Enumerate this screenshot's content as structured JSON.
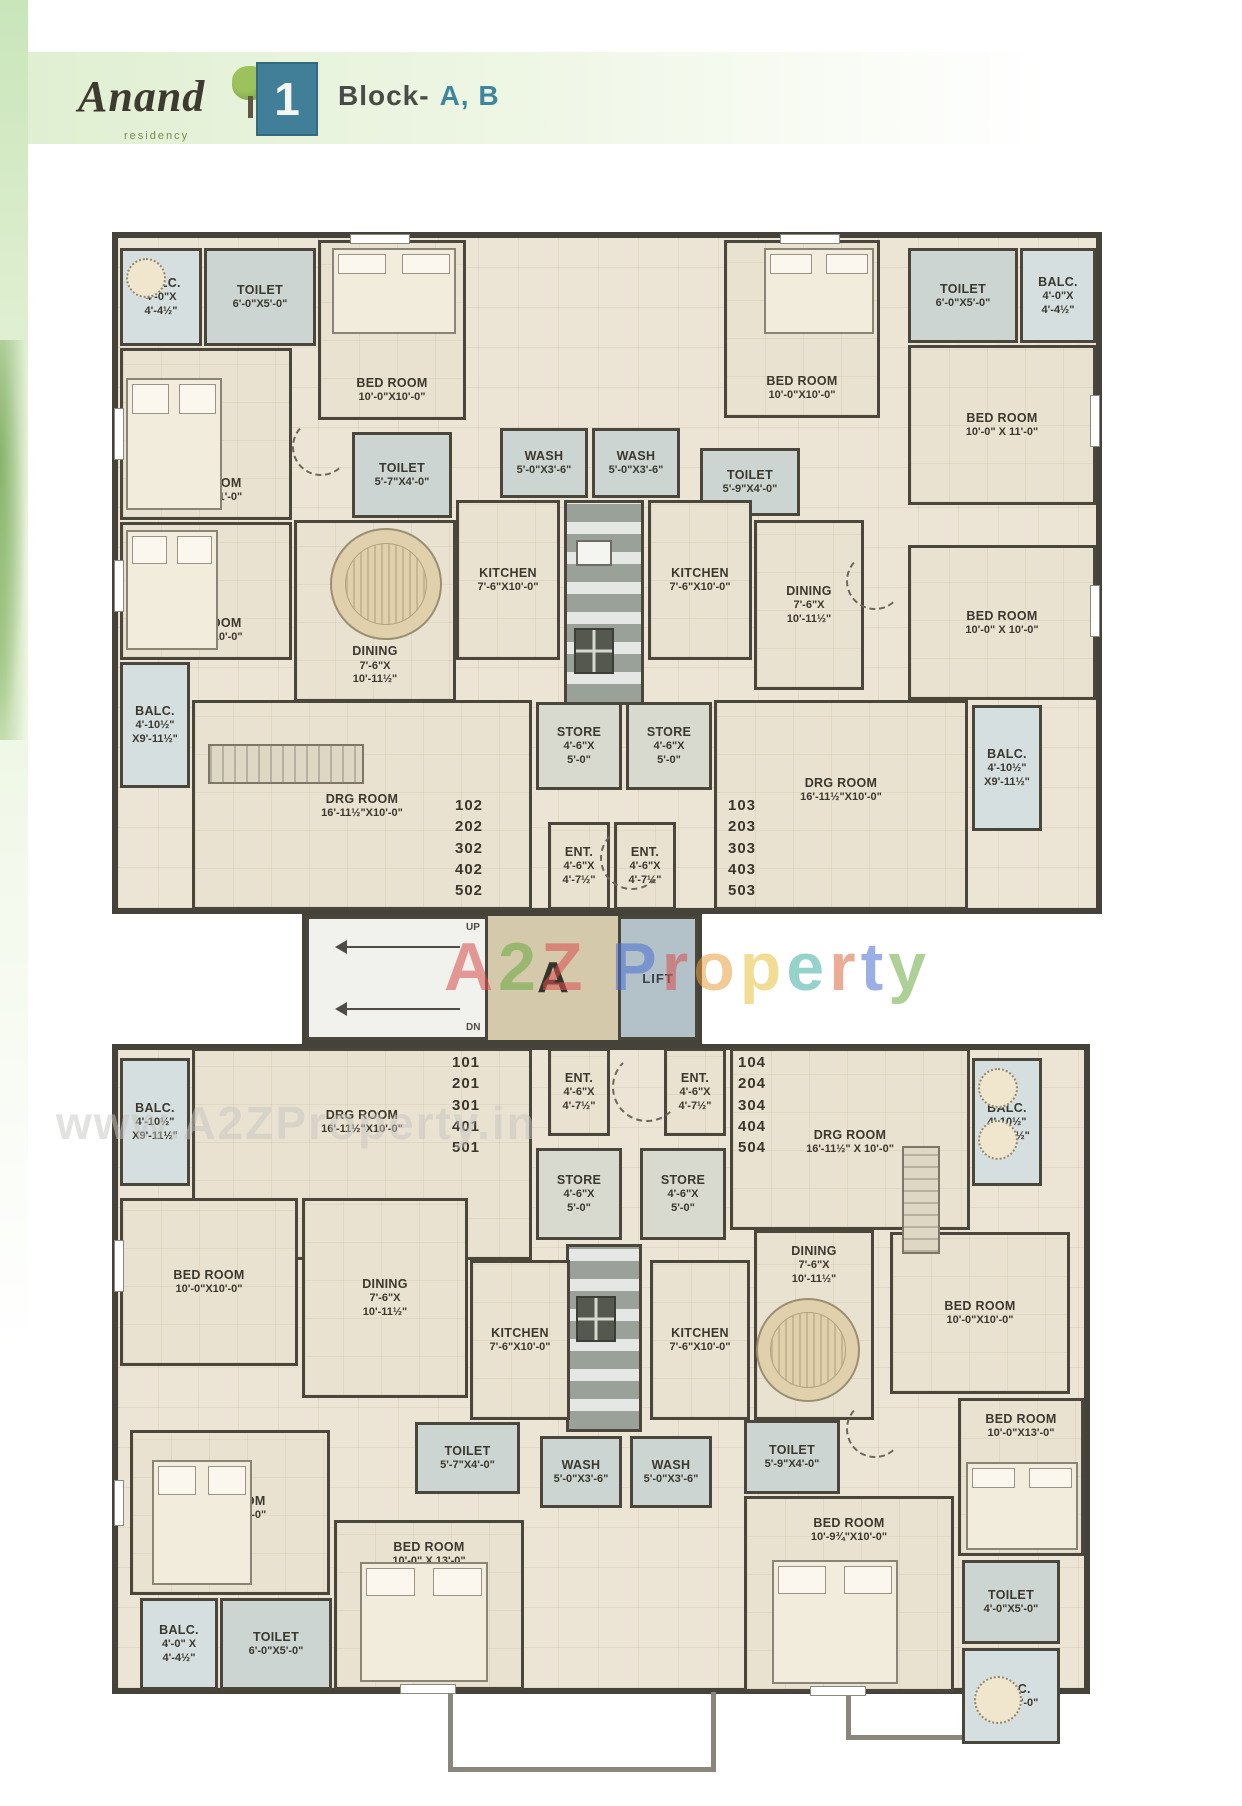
{
  "header": {
    "logo_title": "Anand",
    "logo_subtitle": "residency",
    "sheet_number": "1",
    "block_prefix": "Block-",
    "block_names": "A, B",
    "accent_color": "#3e86a0"
  },
  "core": {
    "lobby_letter": "A",
    "lift_label": "LIFT",
    "up_label": "UP",
    "dn_label": "DN"
  },
  "watermarks": {
    "center_letters": [
      {
        "ch": "A",
        "color": "#d94f4f"
      },
      {
        "ch": "2",
        "color": "#6aaa3f"
      },
      {
        "ch": "Z",
        "color": "#d94f4f"
      },
      {
        "ch": " ",
        "color": "#000000"
      },
      {
        "ch": "P",
        "color": "#4a6fd0"
      },
      {
        "ch": "r",
        "color": "#d94f4f"
      },
      {
        "ch": "o",
        "color": "#e8a03f"
      },
      {
        "ch": "p",
        "color": "#e8c23f"
      },
      {
        "ch": "e",
        "color": "#3fae9f"
      },
      {
        "ch": "r",
        "color": "#d96a3f"
      },
      {
        "ch": "t",
        "color": "#4a6fd0"
      },
      {
        "ch": "y",
        "color": "#6aaa3f"
      }
    ],
    "bottom_text": "www.A2ZProperty.in"
  },
  "plan": {
    "wall_color": "#4a463c",
    "rooms": [
      {
        "name": "balc-top-left",
        "lines": [
          "BALC.",
          "4'-0\"X",
          "4'-4½\""
        ],
        "x": 120,
        "y": 248,
        "w": 82,
        "h": 98,
        "kind": "balc"
      },
      {
        "name": "toilet-top-left",
        "lines": [
          "TOILET",
          "6'-0\"X5'-0\""
        ],
        "x": 204,
        "y": 248,
        "w": 112,
        "h": 98,
        "kind": "wet"
      },
      {
        "name": "bedroom-top-center-left",
        "lines": [
          "BED ROOM",
          "10'-0\"X10'-0\""
        ],
        "x": 318,
        "y": 240,
        "w": 148,
        "h": 180,
        "kind": "room",
        "pos": "bottom"
      },
      {
        "name": "bedroom-left-1",
        "lines": [
          "BED ROOM",
          "10'-0\" X 11'-0\""
        ],
        "x": 120,
        "y": 348,
        "w": 172,
        "h": 172,
        "kind": "room",
        "pos": "bottom"
      },
      {
        "name": "bedroom-left-2",
        "lines": [
          "BED ROOM",
          "10'-0\" X 10'-0\""
        ],
        "x": 120,
        "y": 522,
        "w": 172,
        "h": 138,
        "kind": "room",
        "pos": "bottom"
      },
      {
        "name": "toilet-inner-left",
        "lines": [
          "TOILET",
          "5'-7\"X4'-0\""
        ],
        "x": 352,
        "y": 432,
        "w": 100,
        "h": 86,
        "kind": "wet"
      },
      {
        "name": "wash-left",
        "lines": [
          "WASH",
          "5'-0\"X3'-6\""
        ],
        "x": 500,
        "y": 428,
        "w": 88,
        "h": 70,
        "kind": "wet"
      },
      {
        "name": "wash-right",
        "lines": [
          "WASH",
          "5'-0\"X3'-6\""
        ],
        "x": 592,
        "y": 428,
        "w": 88,
        "h": 70,
        "kind": "wet"
      },
      {
        "name": "toilet-inner-right",
        "lines": [
          "TOILET",
          "5'-9\"X4'-0\""
        ],
        "x": 700,
        "y": 448,
        "w": 100,
        "h": 68,
        "kind": "wet"
      },
      {
        "name": "dining-left",
        "lines": [
          "DINING",
          "7'-6\"X",
          "10'-11½\""
        ],
        "x": 294,
        "y": 520,
        "w": 162,
        "h": 182,
        "kind": "room",
        "pos": "bottom"
      },
      {
        "name": "kitchen-left",
        "lines": [
          "KITCHEN",
          "7'-6\"X10'-0\""
        ],
        "x": 456,
        "y": 500,
        "w": 104,
        "h": 160,
        "kind": "room"
      },
      {
        "name": "kitchen-right",
        "lines": [
          "KITCHEN",
          "7'-6\"X10'-0\""
        ],
        "x": 648,
        "y": 500,
        "w": 104,
        "h": 160,
        "kind": "room"
      },
      {
        "name": "dining-right",
        "lines": [
          "DINING",
          "7'-6\"X",
          "10'-11½\""
        ],
        "x": 754,
        "y": 520,
        "w": 110,
        "h": 170,
        "kind": "room"
      },
      {
        "name": "bedroom-top-center-right",
        "lines": [
          "BED ROOM",
          "10'-0\"X10'-0\""
        ],
        "x": 724,
        "y": 240,
        "w": 156,
        "h": 178,
        "kind": "room",
        "pos": "bottom"
      },
      {
        "name": "toilet-top-right",
        "lines": [
          "TOILET",
          "6'-0\"X5'-0\""
        ],
        "x": 908,
        "y": 248,
        "w": 110,
        "h": 95,
        "kind": "wet"
      },
      {
        "name": "balc-top-right",
        "lines": [
          "BALC.",
          "4'-0\"X",
          "4'-4½\""
        ],
        "x": 1020,
        "y": 248,
        "w": 76,
        "h": 95,
        "kind": "balc"
      },
      {
        "name": "bedroom-right-1",
        "lines": [
          "BED ROOM",
          "10'-0\" X 11'-0\""
        ],
        "x": 908,
        "y": 345,
        "w": 188,
        "h": 160,
        "kind": "room"
      },
      {
        "name": "bedroom-right-2",
        "lines": [
          "BED ROOM",
          "10'-0\" X 10'-0\""
        ],
        "x": 908,
        "y": 545,
        "w": 188,
        "h": 155,
        "kind": "room"
      },
      {
        "name": "store-left",
        "lines": [
          "STORE",
          "4'-6\"X",
          "5'-0\""
        ],
        "x": 536,
        "y": 702,
        "w": 86,
        "h": 88,
        "kind": "store"
      },
      {
        "name": "store-right",
        "lines": [
          "STORE",
          "4'-6\"X",
          "5'-0\""
        ],
        "x": 626,
        "y": 702,
        "w": 86,
        "h": 88,
        "kind": "store"
      },
      {
        "name": "balc-left-mid",
        "lines": [
          "BALC.",
          "4'-10½\"",
          "X9'-11½\""
        ],
        "x": 120,
        "y": 662,
        "w": 70,
        "h": 126,
        "kind": "balc"
      },
      {
        "name": "drg-room-left",
        "lines": [
          "DRG ROOM",
          "16'-11½\"X10'-0\""
        ],
        "x": 192,
        "y": 700,
        "w": 340,
        "h": 210,
        "kind": "room",
        "pos": "top",
        "pt": 88
      },
      {
        "name": "ent-left",
        "lines": [
          "ENT.",
          "4'-6\"X",
          "4'-7½\""
        ],
        "x": 548,
        "y": 822,
        "w": 62,
        "h": 88,
        "kind": "room"
      },
      {
        "name": "ent-right",
        "lines": [
          "ENT.",
          "4'-6\"X",
          "4'-7½\""
        ],
        "x": 614,
        "y": 822,
        "w": 62,
        "h": 88,
        "kind": "room"
      },
      {
        "name": "drg-room-right",
        "lines": [
          "DRG ROOM",
          "16'-11½\"X10'-0\""
        ],
        "x": 714,
        "y": 700,
        "w": 254,
        "h": 210,
        "kind": "room",
        "pos": "top",
        "pt": 72
      },
      {
        "name": "balc-right-mid",
        "lines": [
          "BALC.",
          "4'-10½\"",
          "X9'-11½\""
        ],
        "x": 972,
        "y": 705,
        "w": 70,
        "h": 126,
        "kind": "balc"
      },
      {
        "name": "balc-left-mid-lower",
        "lines": [
          "BALC.",
          "4'-10½\"",
          "X9'-11½\""
        ],
        "x": 120,
        "y": 1058,
        "w": 70,
        "h": 128,
        "kind": "balc"
      },
      {
        "name": "drg-room-left-lower",
        "lines": [
          "DRG ROOM",
          "16'-11½\"X10'-0\""
        ],
        "x": 192,
        "y": 1048,
        "w": 340,
        "h": 212,
        "kind": "room",
        "pos": "top",
        "pt": 56
      },
      {
        "name": "ent-left-lower",
        "lines": [
          "ENT.",
          "4'-6\"X",
          "4'-7½\""
        ],
        "x": 548,
        "y": 1048,
        "w": 62,
        "h": 88,
        "kind": "room"
      },
      {
        "name": "ent-right-lower",
        "lines": [
          "ENT.",
          "4'-6\"X",
          "4'-7½\""
        ],
        "x": 664,
        "y": 1048,
        "w": 62,
        "h": 88,
        "kind": "room"
      },
      {
        "name": "drg-room-right-lower",
        "lines": [
          "DRG ROOM",
          "16'-11½\" X 10'-0\""
        ],
        "x": 730,
        "y": 1048,
        "w": 240,
        "h": 182,
        "kind": "room",
        "pos": "top",
        "pt": 76
      },
      {
        "name": "balc-right-mid-lower",
        "lines": [
          "BALC.",
          "4'-10½\"",
          "X9'-11½\""
        ],
        "x": 972,
        "y": 1058,
        "w": 70,
        "h": 128,
        "kind": "balc"
      },
      {
        "name": "store-left-lower",
        "lines": [
          "STORE",
          "4'-6\"X",
          "5'-0\""
        ],
        "x": 536,
        "y": 1148,
        "w": 86,
        "h": 92,
        "kind": "store"
      },
      {
        "name": "store-right-lower",
        "lines": [
          "STORE",
          "4'-6\"X",
          "5'-0\""
        ],
        "x": 640,
        "y": 1148,
        "w": 86,
        "h": 92,
        "kind": "store"
      },
      {
        "name": "bedroom-left-upper-lower",
        "lines": [
          "BED ROOM",
          "10'-0\"X10'-0\""
        ],
        "x": 120,
        "y": 1198,
        "w": 178,
        "h": 168,
        "kind": "room"
      },
      {
        "name": "dining-left-lower",
        "lines": [
          "DINING",
          "7'-6\"X",
          "10'-11½\""
        ],
        "x": 302,
        "y": 1198,
        "w": 166,
        "h": 200,
        "kind": "room"
      },
      {
        "name": "kitchen-left-lower",
        "lines": [
          "KITCHEN",
          "7'-6\"X10'-0\""
        ],
        "x": 470,
        "y": 1260,
        "w": 100,
        "h": 160,
        "kind": "room"
      },
      {
        "name": "kitchen-right-lower",
        "lines": [
          "KITCHEN",
          "7'-6\"X10'-0\""
        ],
        "x": 650,
        "y": 1260,
        "w": 100,
        "h": 160,
        "kind": "room"
      },
      {
        "name": "dining-right-lower",
        "lines": [
          "DINING",
          "7'-6\"X",
          "10'-11½\""
        ],
        "x": 754,
        "y": 1230,
        "w": 120,
        "h": 190,
        "kind": "room",
        "pos": "top",
        "pt": 10
      },
      {
        "name": "bedroom-right-upper-lower",
        "lines": [
          "BED ROOM",
          "10'-0\"X10'-0\""
        ],
        "x": 890,
        "y": 1232,
        "w": 180,
        "h": 162,
        "kind": "room"
      },
      {
        "name": "toilet-inner-left-lower",
        "lines": [
          "TOILET",
          "5'-7\"X4'-0\""
        ],
        "x": 415,
        "y": 1422,
        "w": 105,
        "h": 72,
        "kind": "wet"
      },
      {
        "name": "wash-left-lower",
        "lines": [
          "WASH",
          "5'-0\"X3'-6\""
        ],
        "x": 540,
        "y": 1436,
        "w": 82,
        "h": 72,
        "kind": "wet"
      },
      {
        "name": "wash-right-lower",
        "lines": [
          "WASH",
          "5'-0\"X3'-6\""
        ],
        "x": 630,
        "y": 1436,
        "w": 82,
        "h": 72,
        "kind": "wet"
      },
      {
        "name": "toilet-inner-right-lower",
        "lines": [
          "TOILET",
          "5'-9\"X4'-0\""
        ],
        "x": 744,
        "y": 1420,
        "w": 96,
        "h": 74,
        "kind": "wet"
      },
      {
        "name": "bedroom-left-mid-lower",
        "lines": [
          "BED ROOM",
          "10'-0\" X 11'-0\""
        ],
        "x": 130,
        "y": 1430,
        "w": 200,
        "h": 165,
        "kind": "room",
        "pos": "top",
        "pt": 60
      },
      {
        "name": "balc-bottom-left",
        "lines": [
          "BALC.",
          "4'-0\" X",
          "4'-4½\""
        ],
        "x": 140,
        "y": 1598,
        "w": 78,
        "h": 92,
        "kind": "balc"
      },
      {
        "name": "toilet-bottom-left",
        "lines": [
          "TOILET",
          "6'-0\"X5'-0\""
        ],
        "x": 220,
        "y": 1598,
        "w": 112,
        "h": 92,
        "kind": "wet"
      },
      {
        "name": "bedroom-left-bottom-lower",
        "lines": [
          "BED ROOM",
          "10'-0\" X 13'-0\""
        ],
        "x": 334,
        "y": 1520,
        "w": 190,
        "h": 170,
        "kind": "room",
        "pos": "top",
        "pt": 16
      },
      {
        "name": "bedroom-right-mid-lower",
        "lines": [
          "BED ROOM",
          "10'-9¾\"X10'-0\""
        ],
        "x": 744,
        "y": 1496,
        "w": 210,
        "h": 196,
        "kind": "room",
        "pos": "top",
        "pt": 16
      },
      {
        "name": "bedroom-right-bottom-13",
        "lines": [
          "BED ROOM",
          "10'-0\"X13'-0\""
        ],
        "x": 958,
        "y": 1398,
        "w": 126,
        "h": 158,
        "kind": "room",
        "pos": "top",
        "pt": 10
      },
      {
        "name": "toilet-right-edge",
        "lines": [
          "TOILET",
          "4'-0\"X5'-0\""
        ],
        "x": 962,
        "y": 1560,
        "w": 98,
        "h": 84,
        "kind": "wet"
      },
      {
        "name": "balc-right-bottom",
        "lines": [
          "BALC.",
          "4'-0\"X5'-0\""
        ],
        "x": 962,
        "y": 1648,
        "w": 98,
        "h": 96,
        "kind": "balc"
      }
    ],
    "flat_stacks": [
      {
        "name": "flats-102",
        "numbers": [
          "102",
          "202",
          "302",
          "402",
          "502"
        ],
        "x": 455,
        "y": 795,
        "w": 60,
        "h": 108
      },
      {
        "name": "flats-103",
        "numbers": [
          "103",
          "203",
          "303",
          "403",
          "503"
        ],
        "x": 728,
        "y": 795,
        "w": 60,
        "h": 108
      },
      {
        "name": "flats-101",
        "numbers": [
          "101",
          "201",
          "301",
          "401",
          "501"
        ],
        "x": 452,
        "y": 1052,
        "w": 60,
        "h": 108
      },
      {
        "name": "flats-104",
        "numbers": [
          "104",
          "204",
          "304",
          "404",
          "504"
        ],
        "x": 738,
        "y": 1052,
        "w": 60,
        "h": 108
      }
    ],
    "furniture": [
      {
        "type": "shaft",
        "x": 564,
        "y": 500,
        "w": 80,
        "h": 205
      },
      {
        "type": "shaft",
        "x": 566,
        "y": 1244,
        "w": 76,
        "h": 188
      },
      {
        "type": "bed",
        "x": 332,
        "y": 248,
        "w": 124,
        "h": 86
      },
      {
        "type": "bed",
        "x": 126,
        "y": 378,
        "w": 96,
        "h": 132
      },
      {
        "type": "bed",
        "x": 126,
        "y": 530,
        "w": 92,
        "h": 120
      },
      {
        "type": "bed",
        "x": 764,
        "y": 248,
        "w": 110,
        "h": 86
      },
      {
        "type": "bed",
        "x": 152,
        "y": 1460,
        "w": 100,
        "h": 125
      },
      {
        "type": "bed",
        "x": 360,
        "y": 1562,
        "w": 128,
        "h": 120
      },
      {
        "type": "bed",
        "x": 772,
        "y": 1560,
        "w": 126,
        "h": 124
      },
      {
        "type": "bed",
        "x": 966,
        "y": 1462,
        "w": 112,
        "h": 88
      },
      {
        "type": "table",
        "x": 330,
        "y": 528,
        "w": 112,
        "h": 112
      },
      {
        "type": "table",
        "x": 756,
        "y": 1298,
        "w": 104,
        "h": 104
      },
      {
        "type": "circle",
        "x": 126,
        "y": 258,
        "w": 40,
        "h": 40
      },
      {
        "type": "circle",
        "x": 978,
        "y": 1068,
        "w": 40,
        "h": 40
      },
      {
        "type": "circle",
        "x": 978,
        "y": 1120,
        "w": 40,
        "h": 40
      },
      {
        "type": "circle",
        "x": 974,
        "y": 1676,
        "w": 48,
        "h": 48
      },
      {
        "type": "sofa",
        "x": 208,
        "y": 744,
        "w": 156,
        "h": 40
      },
      {
        "type": "sofa-v",
        "x": 902,
        "y": 1146,
        "w": 38,
        "h": 108
      },
      {
        "type": "stove",
        "x": 574,
        "y": 628,
        "w": 40,
        "h": 46
      },
      {
        "type": "sink",
        "x": 576,
        "y": 540,
        "w": 36,
        "h": 26
      },
      {
        "type": "stove",
        "x": 576,
        "y": 1296,
        "w": 40,
        "h": 46
      },
      {
        "type": "win-v",
        "x": 114,
        "y": 408,
        "w": 10,
        "h": 52
      },
      {
        "type": "win-v",
        "x": 114,
        "y": 560,
        "w": 10,
        "h": 52
      },
      {
        "type": "win-h",
        "x": 350,
        "y": 234,
        "w": 60,
        "h": 10
      },
      {
        "type": "win-h",
        "x": 780,
        "y": 234,
        "w": 60,
        "h": 10
      },
      {
        "type": "win-v",
        "x": 1090,
        "y": 395,
        "w": 10,
        "h": 52
      },
      {
        "type": "win-v",
        "x": 1090,
        "y": 585,
        "w": 10,
        "h": 52
      },
      {
        "type": "win-v",
        "x": 114,
        "y": 1240,
        "w": 10,
        "h": 52
      },
      {
        "type": "win-v",
        "x": 114,
        "y": 1480,
        "w": 10,
        "h": 46
      },
      {
        "type": "win-h",
        "x": 400,
        "y": 1684,
        "w": 56,
        "h": 10
      },
      {
        "type": "win-h",
        "x": 810,
        "y": 1686,
        "w": 56,
        "h": 10
      },
      {
        "type": "arc",
        "x": 600,
        "y": 826,
        "w": 64,
        "h": 64
      },
      {
        "type": "arc",
        "x": 612,
        "y": 1052,
        "w": 70,
        "h": 70
      },
      {
        "type": "arc",
        "x": 292,
        "y": 418,
        "w": 58,
        "h": 58
      },
      {
        "type": "arc",
        "x": 846,
        "y": 552,
        "w": 58,
        "h": 58
      },
      {
        "type": "arc",
        "x": 846,
        "y": 1400,
        "w": 58,
        "h": 58
      },
      {
        "type": "stub",
        "x": 448,
        "y": 1692,
        "w": 268,
        "h": 80
      },
      {
        "type": "stub",
        "x": 846,
        "y": 1692,
        "w": 160,
        "h": 48
      }
    ]
  }
}
